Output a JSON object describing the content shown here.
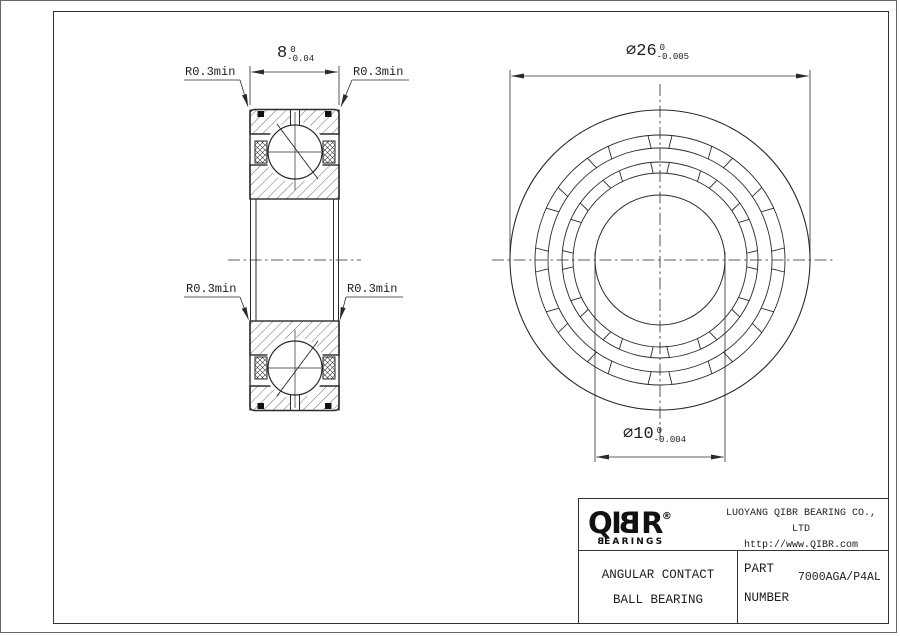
{
  "colors": {
    "line": "#2a2a2a",
    "seal": "#111111",
    "background": "#ffffff"
  },
  "views": {
    "section": {
      "width_dim": {
        "value": "8",
        "tol_upper": "0",
        "tol_lower": "-0.04"
      },
      "fillet_labels": {
        "top_left": "R0.3min",
        "top_right": "R0.3min",
        "mid_left": "R0.3min",
        "mid_right": "R0.3min"
      }
    },
    "front": {
      "outer_dia_dim": {
        "symbol": "∅",
        "value": "26",
        "tol_upper": "0",
        "tol_lower": "-0.005"
      },
      "bore_dia_dim": {
        "symbol": "∅",
        "value": "10",
        "tol_upper": "0",
        "tol_lower": "-0.004"
      }
    }
  },
  "title_block": {
    "logo": {
      "l1": "Q",
      "l2": "I",
      "l3": "B",
      "l4": "R",
      "registered": "®",
      "sub_first": "B",
      "sub_rest": "EARINGS"
    },
    "company_name": "LUOYANG QIBR BEARING CO., LTD",
    "website": "http://www.QIBR.com",
    "product": {
      "line1": "ANGULAR CONTACT",
      "line2": "BALL BEARING"
    },
    "part_label": {
      "line1": "PART",
      "line2": "NUMBER"
    },
    "part_number": "7000AGA/P4AL"
  }
}
